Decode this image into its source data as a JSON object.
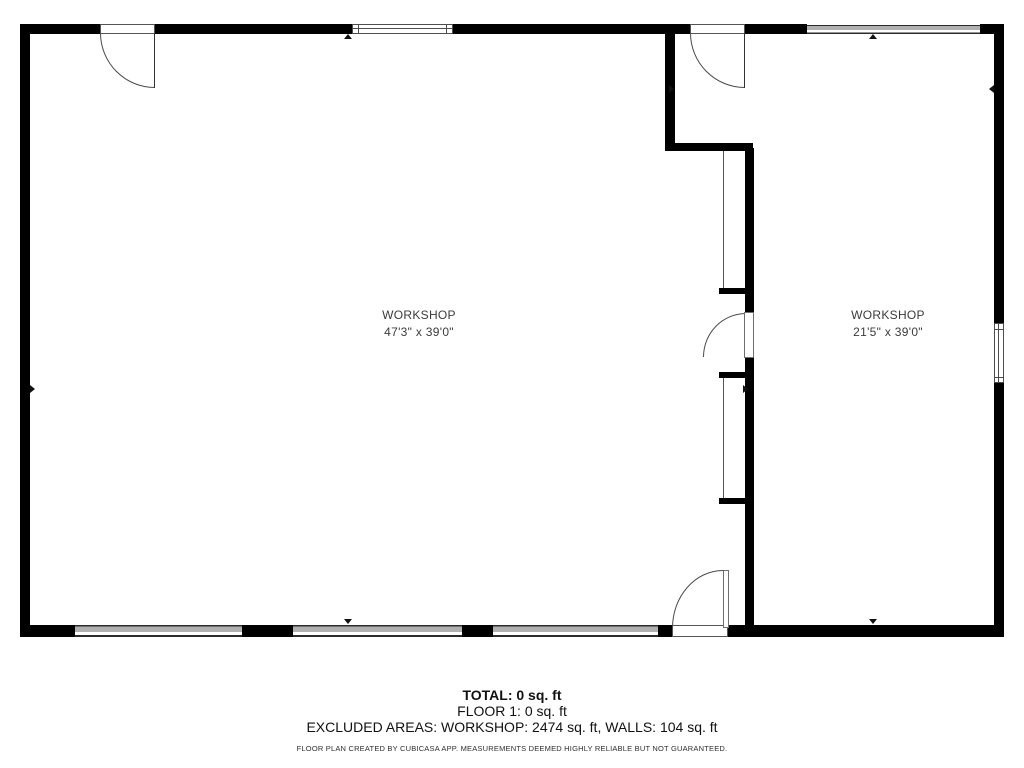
{
  "plan": {
    "rooms": [
      {
        "name": "WORKSHOP",
        "dimensions": "47'3\" x 39'0\""
      },
      {
        "name": "WORKSHOP",
        "dimensions": "21'5\" x 39'0\""
      }
    ],
    "summary": {
      "total_label": "TOTAL: 0 sq. ft",
      "floor_label": "FLOOR 1: 0 sq. ft",
      "excluded_label": "EXCLUDED AREAS: WORKSHOP: 2474 sq. ft, WALLS: 104 sq. ft"
    },
    "disclaimer": "FLOOR PLAN CREATED BY CUBICASA APP. MEASUREMENTS DEEMED HIGHLY RELIABLE BUT NOT GUARANTEED.",
    "colors": {
      "wall": "#000000",
      "window_fill": "#b0b0b0",
      "door_line": "#4a4a4a",
      "text_primary": "#111111",
      "text_room": "#3b3b3b",
      "background": "#ffffff"
    }
  }
}
